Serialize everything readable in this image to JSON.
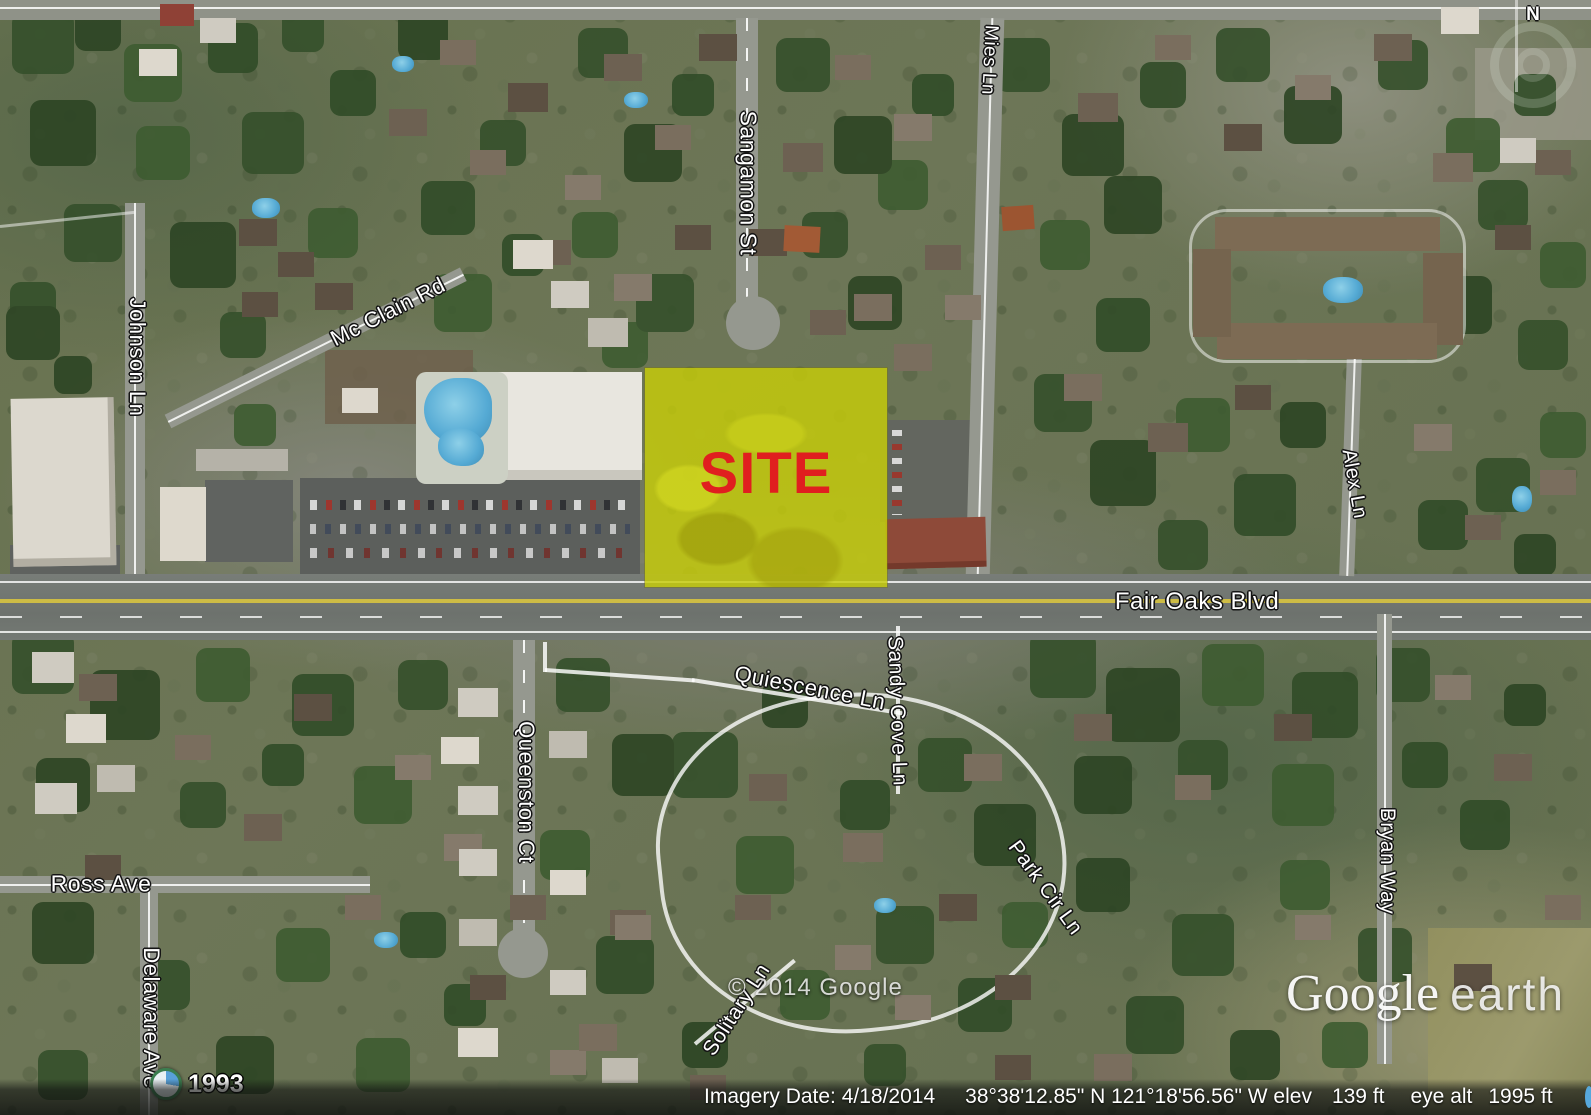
{
  "map": {
    "site_label": "SITE",
    "copyright": "© 2014 Google",
    "compass_north": "N",
    "historical_year": "1993",
    "logo": {
      "google": "Google",
      "earth": "earth"
    }
  },
  "streets": [
    {
      "id": "sangamon-st",
      "text": "Sangamon St"
    },
    {
      "id": "mies-ln",
      "text": "Mies Ln"
    },
    {
      "id": "mcclain-rd",
      "text": "Mc Clain Rd"
    },
    {
      "id": "johnson-ln",
      "text": "Johnson Ln"
    },
    {
      "id": "fair-oaks-blvd",
      "text": "Fair Oaks Blvd"
    },
    {
      "id": "quiescence-ln",
      "text": "Quiescence Ln"
    },
    {
      "id": "sandy-cove-ln",
      "text": "Sandy Cove Ln"
    },
    {
      "id": "alex-ln",
      "text": "Alex Ln"
    },
    {
      "id": "bryan-way",
      "text": "Bryan Way"
    },
    {
      "id": "queenston-ct",
      "text": "Queenston Ct"
    },
    {
      "id": "ross-ave",
      "text": "Ross Ave"
    },
    {
      "id": "delaware-ave",
      "text": "Delaware Ave"
    },
    {
      "id": "park-cir-ln",
      "text": "Park Cir Ln"
    },
    {
      "id": "solitary-ln",
      "text": "Solitary Ln"
    }
  ],
  "status_bar": {
    "imagery_date": "Imagery Date: 4/18/2014",
    "coordinates": "38°38'12.85\" N  121°18'56.56\" W elev",
    "elevation": "139 ft",
    "eye_alt_label": "eye alt",
    "eye_altitude": "1995 ft"
  },
  "colors": {
    "site_fill": "#c7cd08",
    "site_text": "#e01f1f",
    "road_label_text": "#ffffff",
    "fair_oaks_centerline_yellow": "#cdbc45",
    "status_icon_blue": "#57a8dc"
  }
}
